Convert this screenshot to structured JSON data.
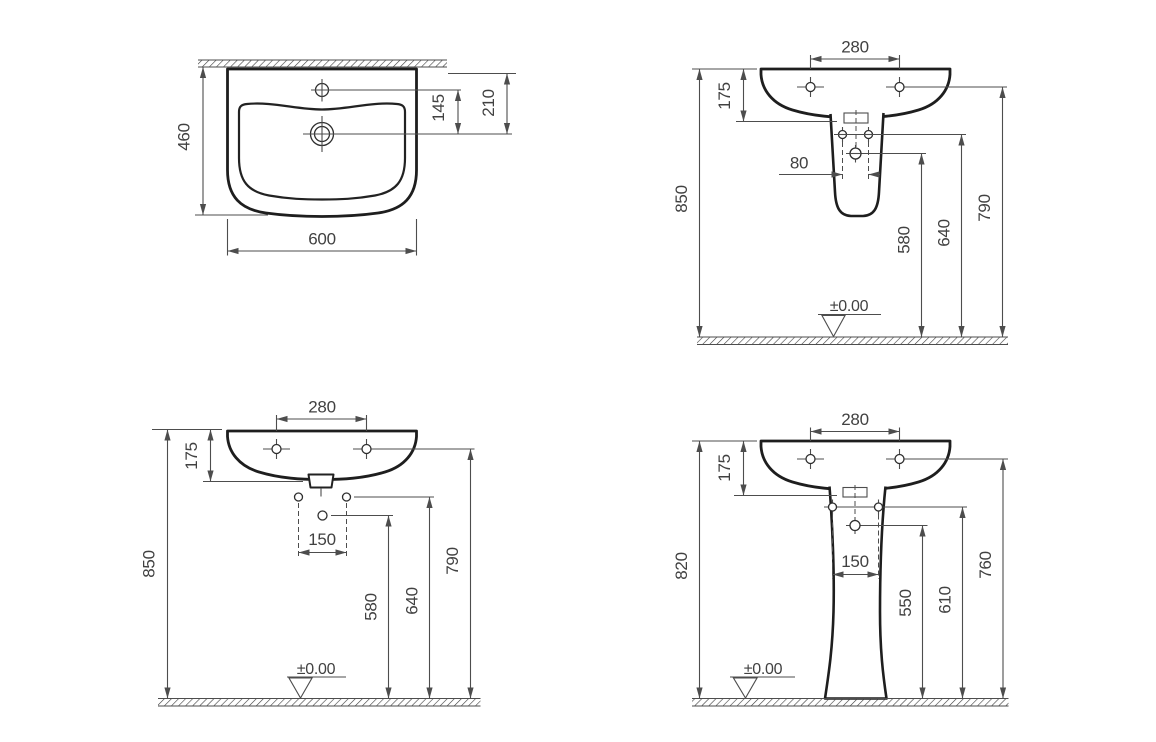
{
  "style": {
    "ink": "#1e1e1e",
    "thin_line": "#4d4d4d",
    "text": "#414141",
    "background": "#ffffff"
  },
  "views": {
    "plan": {
      "d460": "460",
      "d600": "600",
      "d145": "145",
      "d210": "210"
    },
    "semi": {
      "d280": "280",
      "d175": "175",
      "d80": "80",
      "d850": "850",
      "d580": "580",
      "d640": "640",
      "d790": "790",
      "datum": "±0.00"
    },
    "front": {
      "d280": "280",
      "d175": "175",
      "d150": "150",
      "d850": "850",
      "d580": "580",
      "d640": "640",
      "d790": "790",
      "datum": "±0.00"
    },
    "pedestal": {
      "d280": "280",
      "d175": "175",
      "d150": "150",
      "d820": "820",
      "d550": "550",
      "d610": "610",
      "d760": "760",
      "datum": "±0.00"
    }
  }
}
